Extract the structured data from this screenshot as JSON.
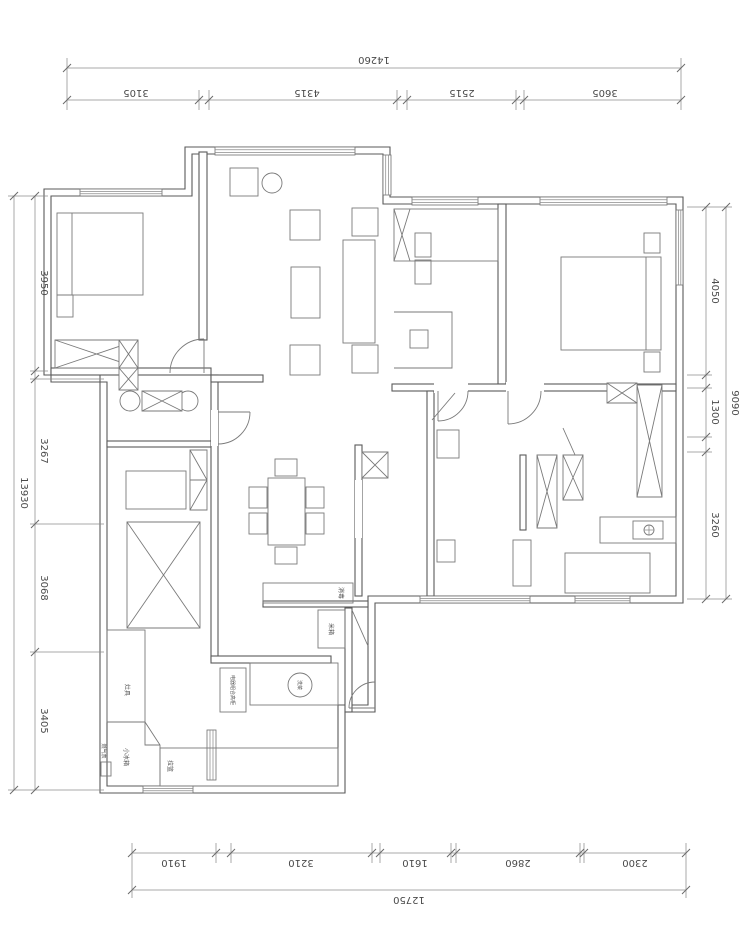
{
  "dimensions": {
    "top": {
      "total": "14260",
      "segments": [
        "3105",
        "4315",
        "2515",
        "3605"
      ]
    },
    "bottom": {
      "total": "12750",
      "segments": [
        "1910",
        "3210",
        "1610",
        "2860",
        "2300"
      ]
    },
    "left": {
      "total": "13930",
      "segments": [
        "3950",
        "3267",
        "3068",
        "3405"
      ]
    },
    "right": {
      "total": "9090",
      "segments": [
        "4050",
        "1300",
        "3260"
      ]
    }
  },
  "labels": {
    "stove": "灶具",
    "fridge": "小冰箱",
    "basket": "拉篮",
    "sink": "洗菜",
    "gas_meter": "燃气表",
    "sterilizer": "消毒",
    "rice_box": "米箱",
    "appliance_cabinet": "电器组合高柜"
  },
  "drawing": {
    "line_color": "#5a5a5a",
    "background": "#ffffff"
  }
}
